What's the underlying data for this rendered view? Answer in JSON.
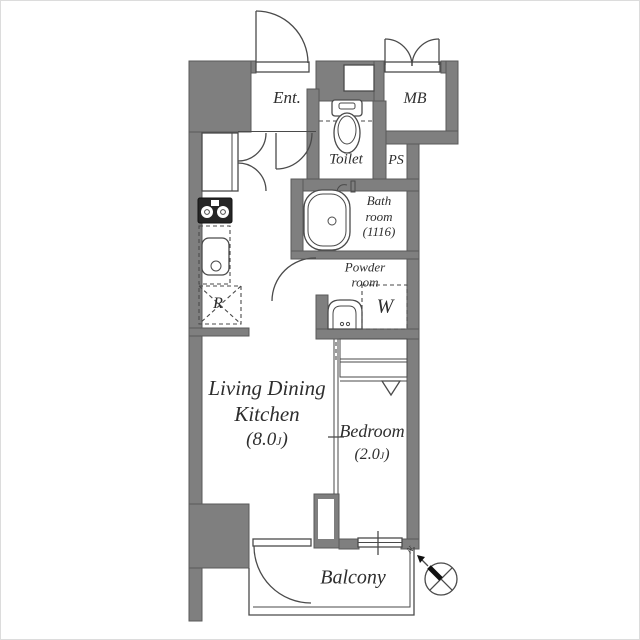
{
  "plan": {
    "title": "apartment-floor-plan",
    "colors": {
      "wall": "#7f7f7f",
      "wall_edge": "#5a5a5a",
      "line": "#4a4a4a",
      "text": "#2e2e2e",
      "bg": "#ffffff"
    },
    "rooms": {
      "entrance": {
        "label": "Ent."
      },
      "meter_box": {
        "label": "MB"
      },
      "toilet": {
        "label": "Toilet"
      },
      "pipe_space": {
        "label": "PS"
      },
      "bathroom": {
        "line1": "Bath",
        "line2": "room",
        "line3": "(1116)"
      },
      "powder_room": {
        "line1": "Powder",
        "line2": "room"
      },
      "washer_space": {
        "label": "W"
      },
      "refrigerator_space": {
        "label": "R"
      },
      "ldk": {
        "line1": "Living Dining",
        "line2": "Kitchen",
        "area_prefix": "(8.0",
        "area_unit": "J",
        "area_suffix": ")"
      },
      "bedroom": {
        "label": "Bedroom",
        "area_prefix": "(2.0",
        "area_unit": "J",
        "area_suffix": ")"
      },
      "balcony": {
        "label": "Balcony"
      }
    },
    "compass": {
      "north_label": "N"
    }
  }
}
